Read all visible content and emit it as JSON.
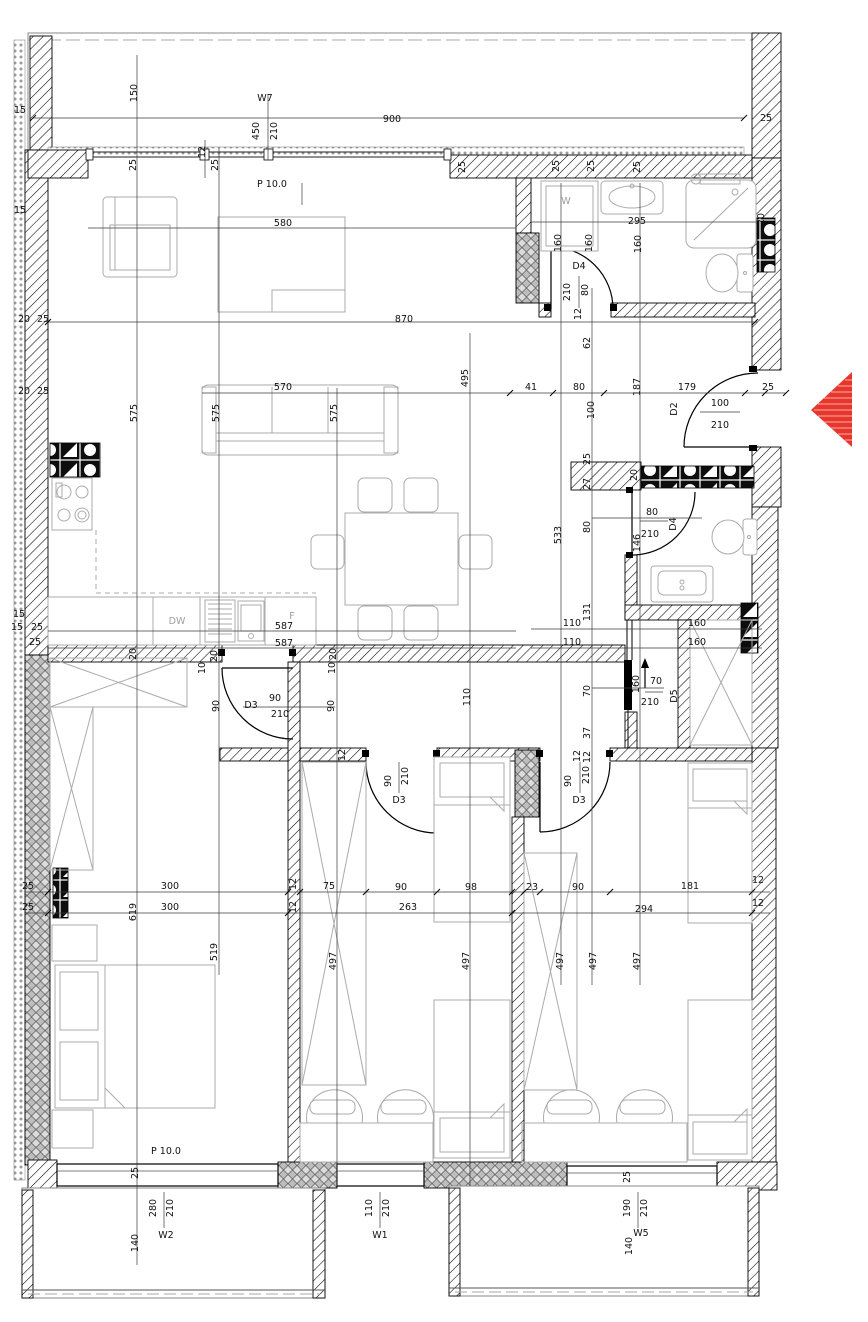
{
  "plan": {
    "type": "apartment-floor-plan",
    "rooms": [
      {
        "id": "living-kitchen",
        "floor_label": "P 10.0"
      },
      {
        "id": "bedroom-main",
        "floor_label": "P 10.0"
      }
    ],
    "windows": [
      {
        "id": "W7",
        "size": "450/210"
      },
      {
        "id": "W2",
        "size": "280/210"
      },
      {
        "id": "W1",
        "size": "110/210"
      },
      {
        "id": "W5",
        "size": "190/210"
      }
    ],
    "doors": [
      {
        "id": "D2",
        "size": "100/210"
      },
      {
        "id": "D3",
        "size": "90/210"
      },
      {
        "id": "D4",
        "size": "80/210"
      },
      {
        "id": "D5",
        "size": "70/210"
      }
    ],
    "appliances": [
      {
        "id": "W",
        "name": "washing-machine"
      },
      {
        "id": "DW",
        "name": "dishwasher"
      },
      {
        "id": "F",
        "name": "fridge"
      }
    ],
    "colors": {
      "wall": "#000000",
      "furniture": "#ababab",
      "entrance_arrow": "#e8362c"
    }
  },
  "labels": [
    {
      "t": "150",
      "x": 137,
      "y": 93,
      "r": -90
    },
    {
      "t": "W7",
      "x": 265,
      "y": 101,
      "s": 11
    },
    {
      "t": "450",
      "x": 259,
      "y": 131,
      "r": -90
    },
    {
      "t": "210",
      "x": 277,
      "y": 131,
      "r": -90
    },
    {
      "t": "900",
      "x": 392,
      "y": 122
    },
    {
      "t": "25",
      "x": 766,
      "y": 121
    },
    {
      "t": "15",
      "x": 20,
      "y": 113
    },
    {
      "t": "15",
      "x": 20,
      "y": 213
    },
    {
      "t": "25",
      "x": 136,
      "y": 165,
      "r": -90
    },
    {
      "t": "12",
      "x": 205,
      "y": 152,
      "r": -90
    },
    {
      "t": "25",
      "x": 218,
      "y": 165,
      "r": -90
    },
    {
      "t": "P 10.0",
      "x": 272,
      "y": 187,
      "s": 11
    },
    {
      "t": "25",
      "x": 465,
      "y": 167,
      "r": -90
    },
    {
      "t": "25",
      "x": 559,
      "y": 166,
      "r": -90
    },
    {
      "t": "25",
      "x": 594,
      "y": 166,
      "r": -90
    },
    {
      "t": "25",
      "x": 640,
      "y": 167,
      "r": -90
    },
    {
      "t": "20",
      "x": 764,
      "y": 219,
      "r": -90
    },
    {
      "t": "580",
      "x": 283,
      "y": 226
    },
    {
      "t": "W",
      "x": 566,
      "y": 204,
      "c": "g",
      "s": 14
    },
    {
      "t": "295",
      "x": 637,
      "y": 224
    },
    {
      "t": "160",
      "x": 561,
      "y": 243,
      "r": -90
    },
    {
      "t": "160",
      "x": 592,
      "y": 243,
      "r": -90
    },
    {
      "t": "160",
      "x": 641,
      "y": 244,
      "r": -90
    },
    {
      "t": "D4",
      "x": 579,
      "y": 269,
      "s": 10.5
    },
    {
      "t": "210",
      "x": 570,
      "y": 292,
      "r": -90
    },
    {
      "t": "80",
      "x": 588,
      "y": 290,
      "r": -90
    },
    {
      "t": "12",
      "x": 581,
      "y": 314,
      "r": -90
    },
    {
      "t": "870",
      "x": 404,
      "y": 322
    },
    {
      "t": "20",
      "x": 24,
      "y": 322
    },
    {
      "t": "25",
      "x": 43,
      "y": 322
    },
    {
      "t": "20",
      "x": 24,
      "y": 394
    },
    {
      "t": "25",
      "x": 43,
      "y": 394
    },
    {
      "t": "62",
      "x": 590,
      "y": 343,
      "r": -90
    },
    {
      "t": "495",
      "x": 468,
      "y": 378,
      "r": -90
    },
    {
      "t": "575",
      "x": 137,
      "y": 413,
      "r": -90
    },
    {
      "t": "575",
      "x": 219,
      "y": 413,
      "r": -90
    },
    {
      "t": "575",
      "x": 337,
      "y": 413,
      "r": -90
    },
    {
      "t": "570",
      "x": 283,
      "y": 390
    },
    {
      "t": "41",
      "x": 531,
      "y": 390
    },
    {
      "t": "80",
      "x": 579,
      "y": 390
    },
    {
      "t": "100",
      "x": 594,
      "y": 410,
      "r": -90
    },
    {
      "t": "187",
      "x": 640,
      "y": 387,
      "r": -90
    },
    {
      "t": "179",
      "x": 687,
      "y": 390
    },
    {
      "t": "25",
      "x": 768,
      "y": 390
    },
    {
      "t": "D2",
      "x": 677,
      "y": 409,
      "r": -90,
      "s": 10.5
    },
    {
      "t": "100",
      "x": 720,
      "y": 406
    },
    {
      "t": "210",
      "x": 720,
      "y": 428
    },
    {
      "t": "25",
      "x": 590,
      "y": 459,
      "r": -90
    },
    {
      "t": "27",
      "x": 590,
      "y": 484,
      "r": -90
    },
    {
      "t": "20",
      "x": 637,
      "y": 475,
      "r": -90
    },
    {
      "t": "80",
      "x": 590,
      "y": 527,
      "r": -90
    },
    {
      "t": "533",
      "x": 561,
      "y": 535,
      "r": -90
    },
    {
      "t": "80",
      "x": 652,
      "y": 515
    },
    {
      "t": "210",
      "x": 650,
      "y": 537
    },
    {
      "t": "D4",
      "x": 676,
      "y": 524,
      "r": -90,
      "s": 10.5
    },
    {
      "t": "146",
      "x": 640,
      "y": 543,
      "r": -90
    },
    {
      "t": "131",
      "x": 590,
      "y": 612,
      "r": -90
    },
    {
      "t": "110",
      "x": 572,
      "y": 626
    },
    {
      "t": "110",
      "x": 572,
      "y": 645
    },
    {
      "t": "160",
      "x": 697,
      "y": 626
    },
    {
      "t": "160",
      "x": 697,
      "y": 645
    },
    {
      "t": "DW",
      "x": 177,
      "y": 624,
      "c": "g",
      "s": 14
    },
    {
      "t": "F",
      "x": 292,
      "y": 619,
      "c": "g",
      "s": 12
    },
    {
      "t": "587",
      "x": 284,
      "y": 629
    },
    {
      "t": "587",
      "x": 284,
      "y": 646
    },
    {
      "t": "15",
      "x": 19,
      "y": 617
    },
    {
      "t": "15",
      "x": 17,
      "y": 630
    },
    {
      "t": "25",
      "x": 37,
      "y": 630
    },
    {
      "t": "25",
      "x": 35,
      "y": 645
    },
    {
      "t": "20",
      "x": 136,
      "y": 654,
      "r": -90
    },
    {
      "t": "20",
      "x": 217,
      "y": 656,
      "r": -90
    },
    {
      "t": "20",
      "x": 336,
      "y": 654,
      "r": -90
    },
    {
      "t": "10",
      "x": 205,
      "y": 668,
      "r": -90
    },
    {
      "t": "10",
      "x": 335,
      "y": 668,
      "r": -90
    },
    {
      "t": "90",
      "x": 219,
      "y": 706,
      "r": -90
    },
    {
      "t": "90",
      "x": 334,
      "y": 706,
      "r": -90
    },
    {
      "t": "110",
      "x": 470,
      "y": 697,
      "r": -90
    },
    {
      "t": "D3",
      "x": 251,
      "y": 708,
      "s": 10.5
    },
    {
      "t": "90",
      "x": 275,
      "y": 701
    },
    {
      "t": "210",
      "x": 280,
      "y": 717
    },
    {
      "t": "160",
      "x": 639,
      "y": 684,
      "r": -90
    },
    {
      "t": "70",
      "x": 656,
      "y": 684
    },
    {
      "t": "210",
      "x": 650,
      "y": 705
    },
    {
      "t": "D5",
      "x": 677,
      "y": 696,
      "r": -90,
      "s": 10.5
    },
    {
      "t": "70",
      "x": 590,
      "y": 691,
      "r": -90
    },
    {
      "t": "37",
      "x": 590,
      "y": 733,
      "r": -90
    },
    {
      "t": "12",
      "x": 590,
      "y": 757,
      "r": -90
    },
    {
      "t": "12",
      "x": 345,
      "y": 755,
      "r": -90
    },
    {
      "t": "90",
      "x": 391,
      "y": 781,
      "r": -90
    },
    {
      "t": "210",
      "x": 408,
      "y": 776,
      "r": -90
    },
    {
      "t": "D3",
      "x": 399,
      "y": 803,
      "s": 10.5
    },
    {
      "t": "12",
      "x": 580,
      "y": 756,
      "r": -90
    },
    {
      "t": "90",
      "x": 571,
      "y": 781,
      "r": -90
    },
    {
      "t": "210",
      "x": 589,
      "y": 775,
      "r": -90
    },
    {
      "t": "D3",
      "x": 579,
      "y": 803,
      "s": 10.5
    },
    {
      "t": "12",
      "x": 296,
      "y": 884,
      "r": -90
    },
    {
      "t": "12",
      "x": 296,
      "y": 907,
      "r": -90
    },
    {
      "t": "300",
      "x": 170,
      "y": 889
    },
    {
      "t": "75",
      "x": 329,
      "y": 889
    },
    {
      "t": "90",
      "x": 401,
      "y": 890
    },
    {
      "t": "98",
      "x": 471,
      "y": 890
    },
    {
      "t": "23",
      "x": 532,
      "y": 890
    },
    {
      "t": "90",
      "x": 578,
      "y": 890
    },
    {
      "t": "181",
      "x": 690,
      "y": 889
    },
    {
      "t": "12",
      "x": 758,
      "y": 883
    },
    {
      "t": "300",
      "x": 170,
      "y": 910
    },
    {
      "t": "263",
      "x": 408,
      "y": 910
    },
    {
      "t": "294",
      "x": 644,
      "y": 912
    },
    {
      "t": "12",
      "x": 758,
      "y": 906
    },
    {
      "t": "619",
      "x": 136,
      "y": 912,
      "r": -90
    },
    {
      "t": "25",
      "x": 28,
      "y": 889
    },
    {
      "t": "25",
      "x": 28,
      "y": 910
    },
    {
      "t": "519",
      "x": 217,
      "y": 952,
      "r": -90
    },
    {
      "t": "497",
      "x": 336,
      "y": 961,
      "r": -90
    },
    {
      "t": "497",
      "x": 469,
      "y": 961,
      "r": -90
    },
    {
      "t": "497",
      "x": 563,
      "y": 961,
      "r": -90
    },
    {
      "t": "497",
      "x": 596,
      "y": 961,
      "r": -90
    },
    {
      "t": "497",
      "x": 640,
      "y": 961,
      "r": -90
    },
    {
      "t": "P 10.0",
      "x": 166,
      "y": 1154,
      "s": 11
    },
    {
      "t": "25",
      "x": 138,
      "y": 1173,
      "r": -90
    },
    {
      "t": "280",
      "x": 156,
      "y": 1208,
      "r": -90
    },
    {
      "t": "210",
      "x": 173,
      "y": 1208,
      "r": -90
    },
    {
      "t": "W2",
      "x": 166,
      "y": 1238,
      "s": 11
    },
    {
      "t": "140",
      "x": 138,
      "y": 1243,
      "r": -90
    },
    {
      "t": "110",
      "x": 372,
      "y": 1208,
      "r": -90
    },
    {
      "t": "210",
      "x": 389,
      "y": 1208,
      "r": -90
    },
    {
      "t": "W1",
      "x": 380,
      "y": 1238,
      "s": 11
    },
    {
      "t": "25",
      "x": 630,
      "y": 1177,
      "r": -90
    },
    {
      "t": "190",
      "x": 630,
      "y": 1208,
      "r": -90
    },
    {
      "t": "210",
      "x": 647,
      "y": 1208,
      "r": -90
    },
    {
      "t": "W5",
      "x": 641,
      "y": 1236,
      "s": 11
    },
    {
      "t": "140",
      "x": 632,
      "y": 1246,
      "r": -90
    }
  ]
}
